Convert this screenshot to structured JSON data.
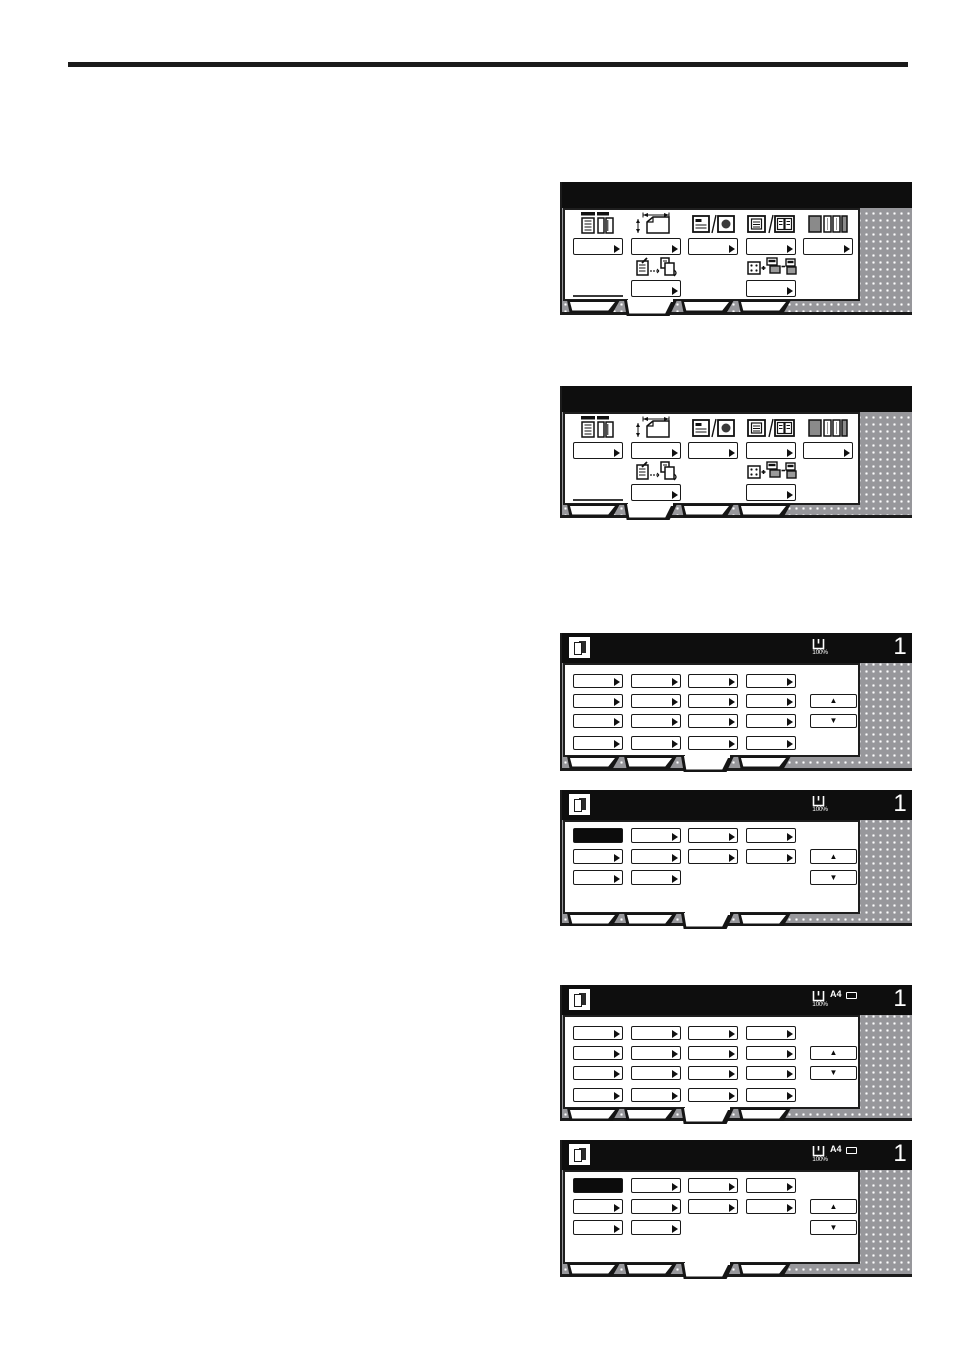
{
  "scroll": {
    "up": "▲",
    "down": "▼"
  },
  "panels": [
    {
      "name": "added-functions-screen-a",
      "kind": "function",
      "active_tab": 1,
      "tabs": 4,
      "columns": [
        {
          "icon": "duplex-pages-icon"
        },
        {
          "icon": "original-size-icon"
        },
        {
          "icon": "text-photo-icon"
        },
        {
          "icon": "book-pages-icon"
        },
        {
          "icon": "sort-stack-icon"
        }
      ],
      "row2": [
        {
          "col": 1,
          "icon": "edit-copy-icon"
        },
        {
          "col": 3,
          "icon": "program-blocks-icon"
        }
      ]
    },
    {
      "name": "added-functions-screen-b",
      "kind": "function",
      "active_tab": 1,
      "tabs": 4,
      "columns": [
        {
          "icon": "duplex-pages-icon"
        },
        {
          "icon": "original-size-icon"
        },
        {
          "icon": "text-photo-icon"
        },
        {
          "icon": "book-pages-icon"
        },
        {
          "icon": "sort-stack-icon"
        }
      ],
      "row2": [
        {
          "col": 1,
          "icon": "edit-copy-icon"
        },
        {
          "col": 3,
          "icon": "program-blocks-icon"
        }
      ]
    },
    {
      "name": "size-list-screen-blank",
      "kind": "list",
      "active_tab": 2,
      "tabs": 4,
      "rows": [
        4,
        4,
        4,
        4
      ],
      "selected": null,
      "indicators": {
        "ratio": "100%",
        "count": "1"
      }
    },
    {
      "name": "size-list-screen-selected",
      "kind": "list",
      "active_tab": 2,
      "tabs": 4,
      "rows": [
        4,
        4,
        2
      ],
      "selected": [
        0,
        0
      ],
      "indicators": {
        "ratio": "100%",
        "count": "1"
      }
    },
    {
      "name": "size-list-screen-a4-blank",
      "kind": "list",
      "active_tab": 2,
      "tabs": 4,
      "rows": [
        4,
        4,
        4,
        4
      ],
      "selected": null,
      "indicators": {
        "ratio": "100%",
        "paper_size": "A4",
        "count": "1"
      }
    },
    {
      "name": "size-list-screen-a4-selected",
      "kind": "list",
      "active_tab": 2,
      "tabs": 4,
      "rows": [
        4,
        4,
        2
      ],
      "selected": [
        0,
        0
      ],
      "indicators": {
        "ratio": "100%",
        "paper_size": "A4",
        "count": "1"
      }
    }
  ]
}
